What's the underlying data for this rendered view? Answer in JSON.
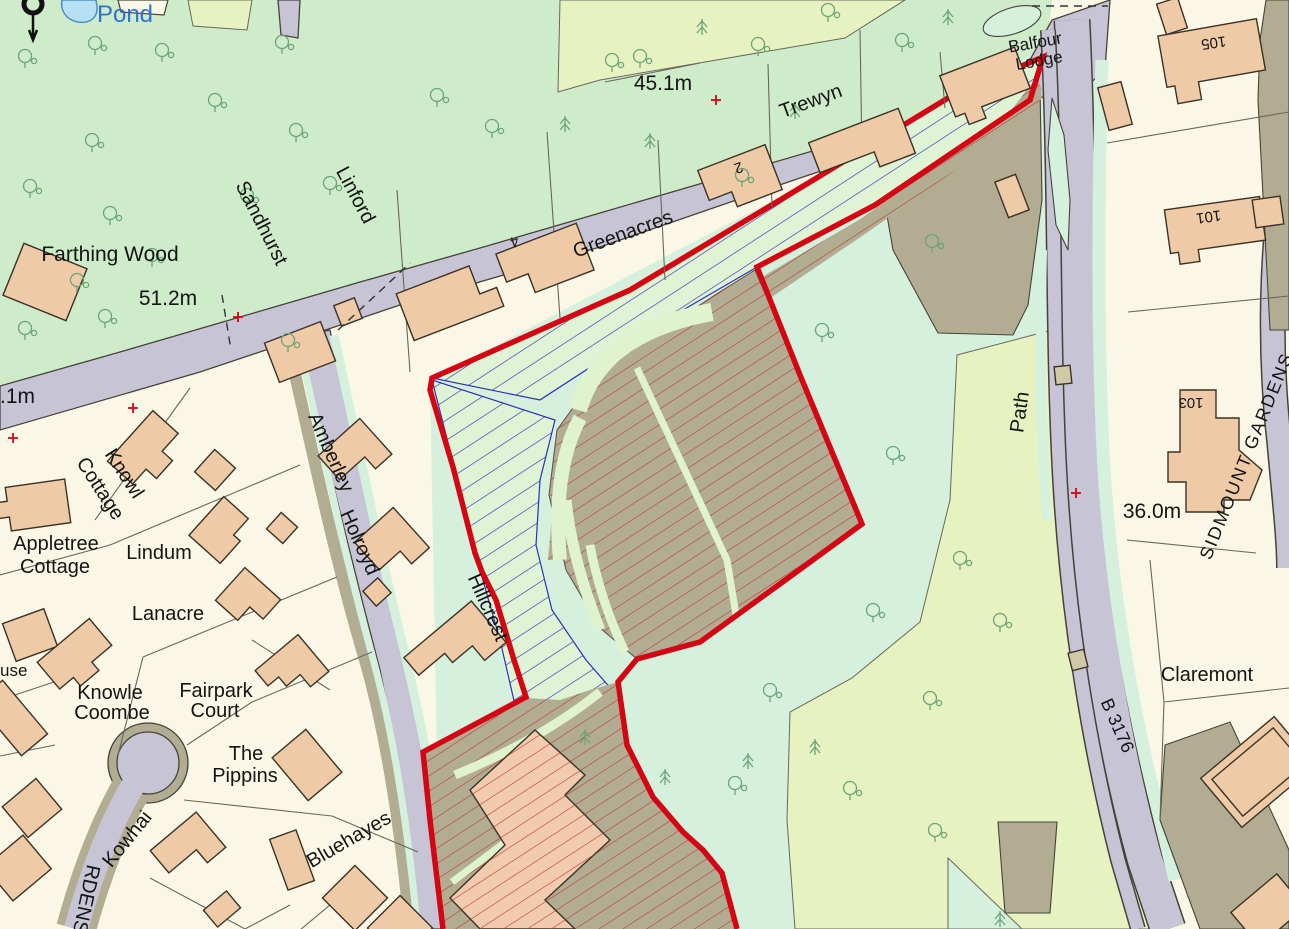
{
  "map": {
    "kind": "ordnance-survey-site-plan",
    "labels": {
      "pond": "Pond",
      "farthing_wood": "Farthing Wood",
      "elev_51_2": "51.2m",
      "elev_45_1": "45.1m",
      "elev_36_0": "36.0m",
      "elev_left_partial": ".1m",
      "sandhurst": "Sandhurst",
      "linford": "Linford",
      "greenacres": "Greenacres",
      "trewyn": "Trewyn",
      "balfour_line1": "Balfour",
      "balfour_line2": "Lodge",
      "no_105": "105",
      "no_101": "101",
      "no_103": "103",
      "no_2": "2",
      "no_4": "4",
      "sidmount_gardens": "SIDMOUNT GARDENS",
      "path": "Path",
      "b3176": "B 3176",
      "claremont": "Claremont",
      "knowl_line1": "Knowl",
      "knowl_line2": "Cottage",
      "appletree_line1": "Appletree",
      "appletree_line2": "Cottage",
      "lindum": "Lindum",
      "lanacre": "Lanacre",
      "house_partial": "use",
      "knowle_line1": "Knowle",
      "knowle_line2": "Coombe",
      "fairpark_line1": "Fairpark",
      "fairpark_line2": "Court",
      "pippins_line1": "The",
      "pippins_line2": "Pippins",
      "kowhai": "Kowhai",
      "bluehayes": "Bluehayes",
      "gardens_partial": "RDENS",
      "amberley": "Amberley",
      "holroyd": "Holroyd",
      "hillcrest": "Hillcrest"
    },
    "colors": {
      "plot_cream": "#fbf7e6",
      "woodland_green": "#cfecca",
      "meadow_mint": "#d5f1de",
      "field_yellow_green": "#e7f2c1",
      "road_grey": "#c7c4d6",
      "track_olive": "#b2ad92",
      "building_salmon": "#eecaa6",
      "building_hatched": "#f2cbae",
      "boundary_red": "#d40613",
      "hatch_red": "#b43b2e",
      "hatch_blue": "#2e2fb5",
      "tree_green": "#6aa477",
      "pond_blue": "#b8e0f5",
      "benchmark_red": "#d40613"
    },
    "symbols": {
      "benchmark_cross": "+",
      "deciduous_tree": "tree-deciduous-icon",
      "conifer_tree": "tree-conifer-icon"
    }
  }
}
